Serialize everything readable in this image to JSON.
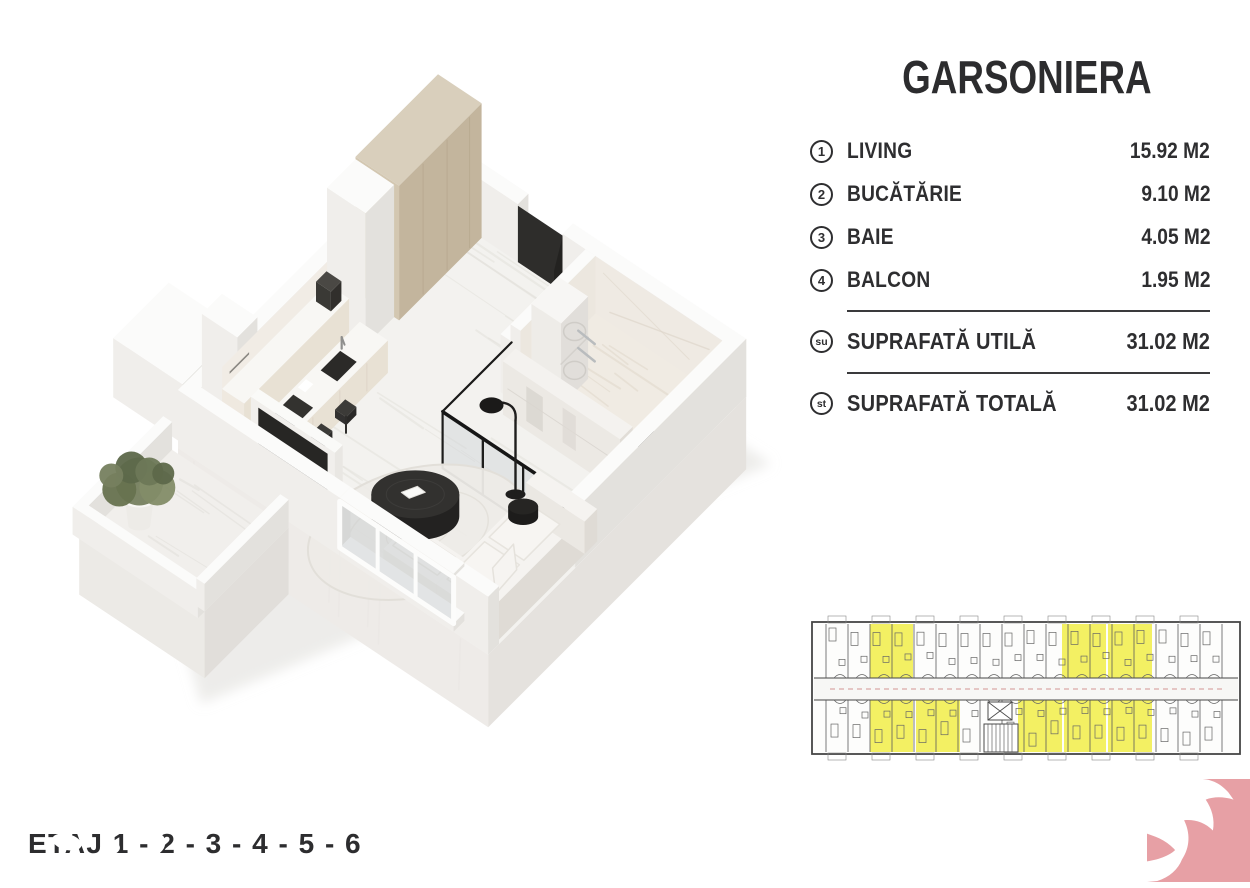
{
  "panel": {
    "title": "GARSONIERA",
    "rooms": [
      {
        "badge": "1",
        "label": "LIVING",
        "area": "15.92 M2"
      },
      {
        "badge": "2",
        "label": "BUCĂTĂRIE",
        "area": "9.10 M2"
      },
      {
        "badge": "3",
        "label": "BAIE",
        "area": "4.05 M2"
      },
      {
        "badge": "4",
        "label": "BALCON",
        "area": "1.95 M2"
      }
    ],
    "totals": [
      {
        "badge": "su",
        "label": "SUPRAFATĂ UTILĂ",
        "area": "31.02 M2"
      },
      {
        "badge": "st",
        "label": "SUPRAFATĂ TOTALĂ",
        "area": "31.02 M2"
      }
    ]
  },
  "footer": {
    "floors_line": "ETAJ 1 - 2 - 3 - 4 - 5 - 6"
  },
  "colors": {
    "text": "#2e2e30",
    "highlight_yellow": "#f2ee52",
    "plan_line": "#5b5b5b",
    "logo_pink": "#e7a0a5",
    "wall_white": "#fbfbfa",
    "cabinet_tan": "#d9cfbc",
    "dark_furniture": "#2b2a28"
  },
  "mini_plan": {
    "highlighted_units": {
      "top_row_x": [
        [
          64,
          107
        ],
        [
          256,
          300
        ],
        [
          302,
          346
        ]
      ],
      "bottom_row_x": [
        [
          64,
          107
        ],
        [
          110,
          154
        ],
        [
          212,
          256
        ],
        [
          258,
          300
        ],
        [
          302,
          346
        ]
      ]
    }
  }
}
